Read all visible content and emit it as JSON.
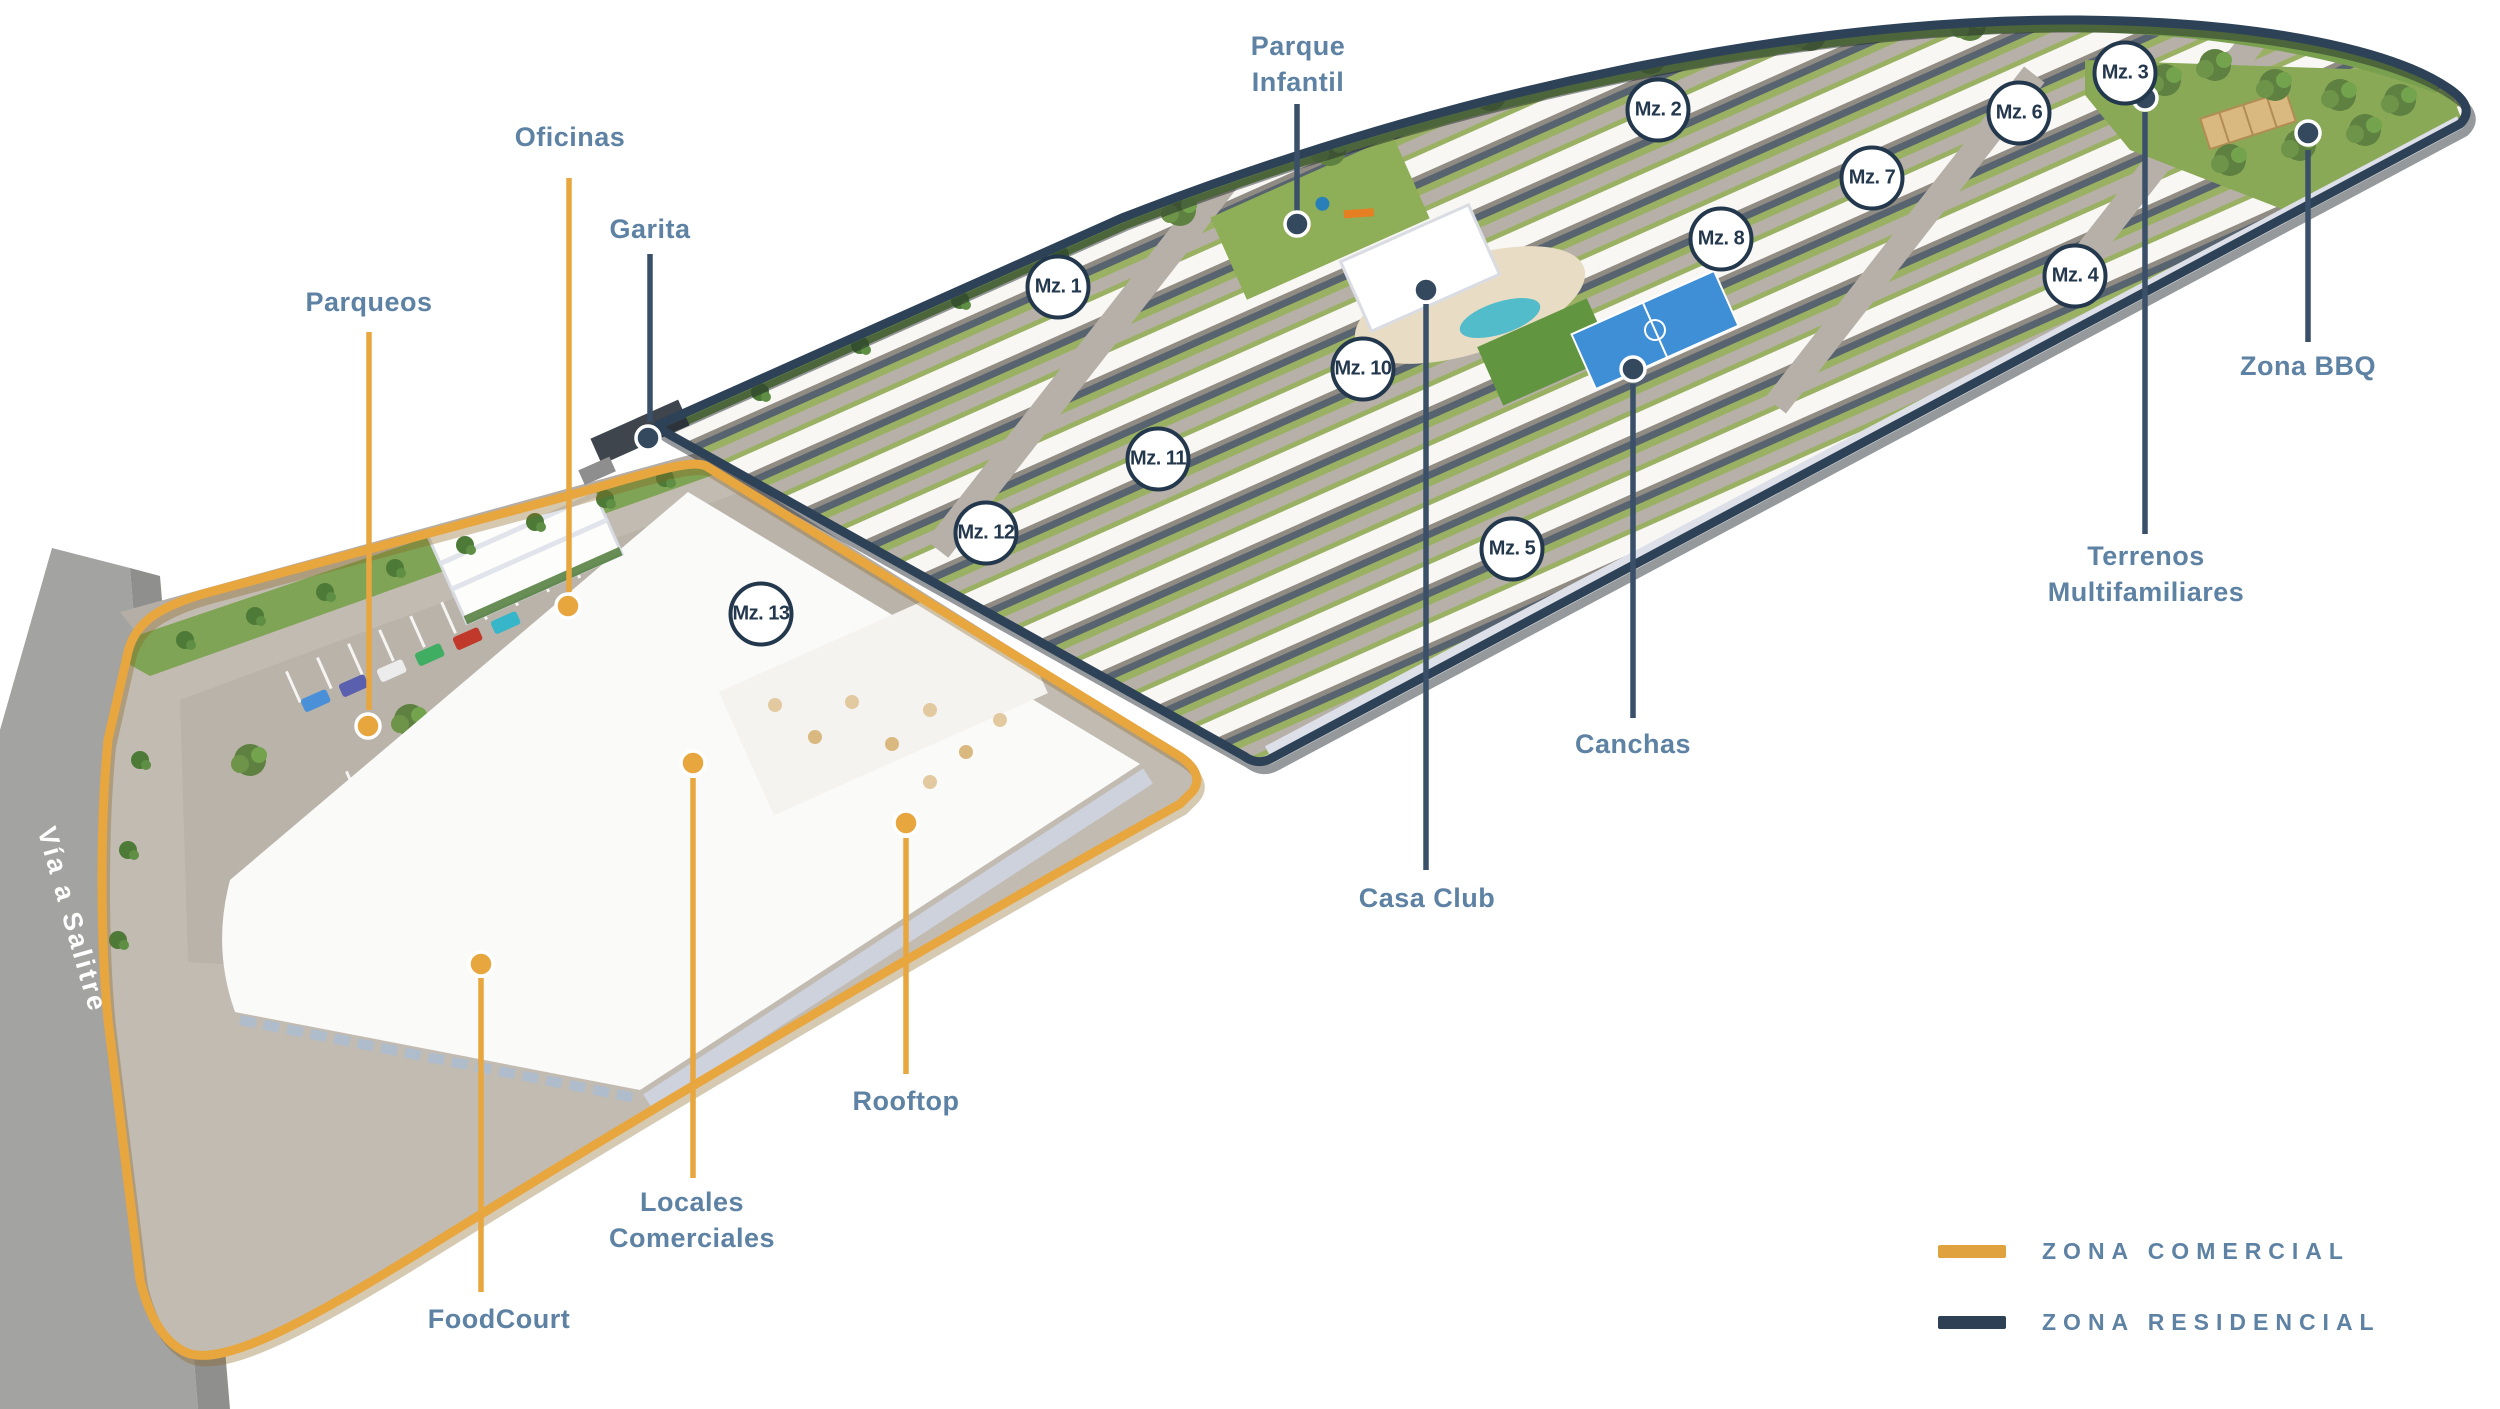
{
  "map_title": "Masterplan urbanización — zonas comercial y residencial",
  "colors": {
    "commercial": "#E8A63F",
    "residential": "#2E4257",
    "label_text": "#5E82A4",
    "marker_text": "#24384D",
    "leader_commercial": "#E8A63F",
    "leader_residential": "#3A5068"
  },
  "road_label": {
    "text": "Vía a Salitre"
  },
  "legend": {
    "items": [
      {
        "id": "zona-comercial",
        "label": "ZONA COMERCIAL",
        "color": "#DFA23E"
      },
      {
        "id": "zona-residencial",
        "label": "ZONA RESIDENCIAL",
        "color": "#2E4154"
      }
    ]
  },
  "mz_markers": [
    {
      "label": "Mz. 1",
      "x": 1058,
      "y": 287
    },
    {
      "label": "Mz. 2",
      "x": 1658,
      "y": 110
    },
    {
      "label": "Mz. 3",
      "x": 2125,
      "y": 73
    },
    {
      "label": "Mz. 4",
      "x": 2075,
      "y": 276
    },
    {
      "label": "Mz. 5",
      "x": 1512,
      "y": 549
    },
    {
      "label": "Mz. 6",
      "x": 2019,
      "y": 113
    },
    {
      "label": "Mz. 7",
      "x": 1872,
      "y": 178
    },
    {
      "label": "Mz. 8",
      "x": 1721,
      "y": 239
    },
    {
      "label": "Mz. 10",
      "x": 1363,
      "y": 369
    },
    {
      "label": "Mz. 11",
      "x": 1158,
      "y": 459
    },
    {
      "label": "Mz. 12",
      "x": 986,
      "y": 533
    },
    {
      "label": "Mz. 13",
      "x": 761,
      "y": 614
    }
  ],
  "labels": [
    {
      "id": "parque-infantil",
      "zone": "residential",
      "lines": [
        "Parque",
        "Infantil"
      ],
      "x": 1298,
      "y": 64,
      "line": {
        "x": 1297,
        "y1": 104,
        "y2": 212
      },
      "dot": {
        "x": 1297,
        "y": 224
      }
    },
    {
      "id": "oficinas",
      "zone": "commercial",
      "lines": [
        "Oficinas"
      ],
      "x": 570,
      "y": 137,
      "line": {
        "x": 569,
        "y1": 178,
        "y2": 592
      },
      "dot": {
        "x": 568,
        "y": 606
      }
    },
    {
      "id": "garita",
      "zone": "residential",
      "lines": [
        "Garita"
      ],
      "x": 650,
      "y": 229,
      "line": {
        "x": 650,
        "y1": 254,
        "y2": 422
      },
      "dot": {
        "x": 648,
        "y": 438
      }
    },
    {
      "id": "parqueos",
      "zone": "commercial",
      "lines": [
        "Parqueos"
      ],
      "x": 369,
      "y": 302,
      "line": {
        "x": 369,
        "y1": 332,
        "y2": 710
      },
      "dot": {
        "x": 368,
        "y": 726
      }
    },
    {
      "id": "zona-bbq",
      "zone": "residential",
      "lines": [
        "Zona BBQ"
      ],
      "x": 2308,
      "y": 366,
      "line": {
        "x": 2308,
        "y1": 150,
        "y2": 342
      },
      "dot": {
        "x": 2308,
        "y": 133
      }
    },
    {
      "id": "terrenos-multifamiliares",
      "zone": "residential",
      "lines": [
        "Terrenos",
        "Multifamiliares"
      ],
      "x": 2146,
      "y": 574,
      "line": {
        "x": 2145,
        "y1": 112,
        "y2": 534
      },
      "dot": {
        "x": 2145,
        "y": 98
      }
    },
    {
      "id": "canchas",
      "zone": "residential",
      "lines": [
        "Canchas"
      ],
      "x": 1633,
      "y": 744,
      "line": {
        "x": 1633,
        "y1": 384,
        "y2": 718
      },
      "dot": {
        "x": 1633,
        "y": 369
      }
    },
    {
      "id": "casa-club",
      "zone": "residential",
      "lines": [
        "Casa Club"
      ],
      "x": 1427,
      "y": 898,
      "line": {
        "x": 1426,
        "y1": 304,
        "y2": 870
      },
      "dot": {
        "x": 1426,
        "y": 290
      }
    },
    {
      "id": "rooftop",
      "zone": "commercial",
      "lines": [
        "Rooftop"
      ],
      "x": 906,
      "y": 1101,
      "line": {
        "x": 906,
        "y1": 838,
        "y2": 1074
      },
      "dot": {
        "x": 906,
        "y": 823
      }
    },
    {
      "id": "locales-comerciales",
      "zone": "commercial",
      "lines": [
        "Locales",
        "Comerciales"
      ],
      "x": 692,
      "y": 1220,
      "line": {
        "x": 693,
        "y1": 778,
        "y2": 1178
      },
      "dot": {
        "x": 693,
        "y": 763
      }
    },
    {
      "id": "foodcourt",
      "zone": "commercial",
      "lines": [
        "FoodCourt"
      ],
      "x": 499,
      "y": 1319,
      "line": {
        "x": 481,
        "y1": 978,
        "y2": 1292
      },
      "dot": {
        "x": 481,
        "y": 964
      }
    }
  ]
}
